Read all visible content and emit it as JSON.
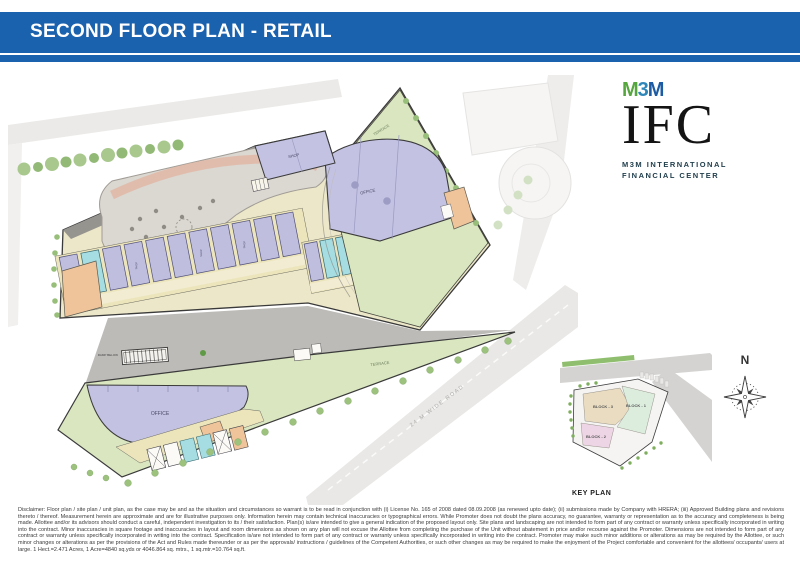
{
  "header": {
    "title": "SECOND FLOOR PLAN - RETAIL"
  },
  "logo": {
    "m1": "M",
    "three": "3",
    "m2": "M",
    "name": "IFC",
    "tagline_line1": "M3M INTERNATIONAL",
    "tagline_line2": "FINANCIAL CENTER"
  },
  "compass": {
    "north_label": "N"
  },
  "plan": {
    "labels": {
      "shop": "SHOP",
      "office_upper": "OFFICE",
      "office_lower": "OFFICE",
      "terrace_upper": "TERRACE",
      "terrace_lower": "TERRACE",
      "ramp": "RAMP BELOW",
      "road": "24 M WIDE ROAD"
    }
  },
  "key_plan": {
    "title": "KEY PLAN",
    "block_3": "BLOCK - 3",
    "block_1": "BLOCK - 1",
    "block_2": "BLOCK - 2"
  },
  "disclaimer": "Disclaimer: Floor plan / site plan / unit plan, as the case may be and as the situation and circumstances so warrant is to be read in conjunction with (i) License No. 165 of 2008 dated 08.09.2008 (as renewed upto date); (ii) submissions made by Company with HRERA; (iii) Approved Building plans and revisions thereto / thereof. Measurement herein are approximate and are for illustrative purposes only. Information herein may contain technical inaccuracies or typographical errors. While Promoter does not doubt the plans accuracy, no guarantee, warranty or representation as to the accuracy and completeness is being made. Allottee and/or its advisors should conduct a careful, independent investigation to its / their satisfaction. Plan(s) is/are intended to give a general indication of the proposed layout only. Site plans and landscaping are not intended to form part of any contract or warranty unless specifically incorporated in writing into the contract. Minor inaccuracies in square footage and inaccuracies in layout and room dimensions as shown on any plan will not excuse the Allottee from completing the purchase of the Unit without abatement in price and/or recourse against the Promoter. Dimensions are not intended to form part of any contract or warranty unless specifically incorporated in writing into the contract. Specification is/are not intended to form part of any contract or warranty unless specifically incorporated in writing into the contract. Promoter may make such minor additions or alterations as may be required by the Allottee, or such minor changes or alterations as per the provisions of the Act and Rules made thereunder or as per the approvals/ instructions / guidelines of the Competent Authorities, or such other changes as may be required to make the enjoyment of the Project comfortable and convenient for the allottees/ occupants/ users at large. 1 Hect.=2.471 Acres, 1 Acre=4840 sq.yds or 4046.864 sq. mtrs., 1 sq.mtr.=10.764 sq.ft.",
  "colors": {
    "header_bar": "#1a61ae",
    "m3m_green": "#55a63c",
    "m3m_blue": "#2f86b9",
    "m3m_dark_blue": "#1d5ba4",
    "shop_unit_lavender": "#bfbedf",
    "terrace_green": "#d9e6c0",
    "corridor_yellow": "#ece5bc",
    "toilet_cyan": "#a5dde2",
    "service_orange": "#f0c49a",
    "key_block_3": "#eadcc0",
    "key_block_1": "#dcedde",
    "key_block_2": "#edd5e5"
  }
}
